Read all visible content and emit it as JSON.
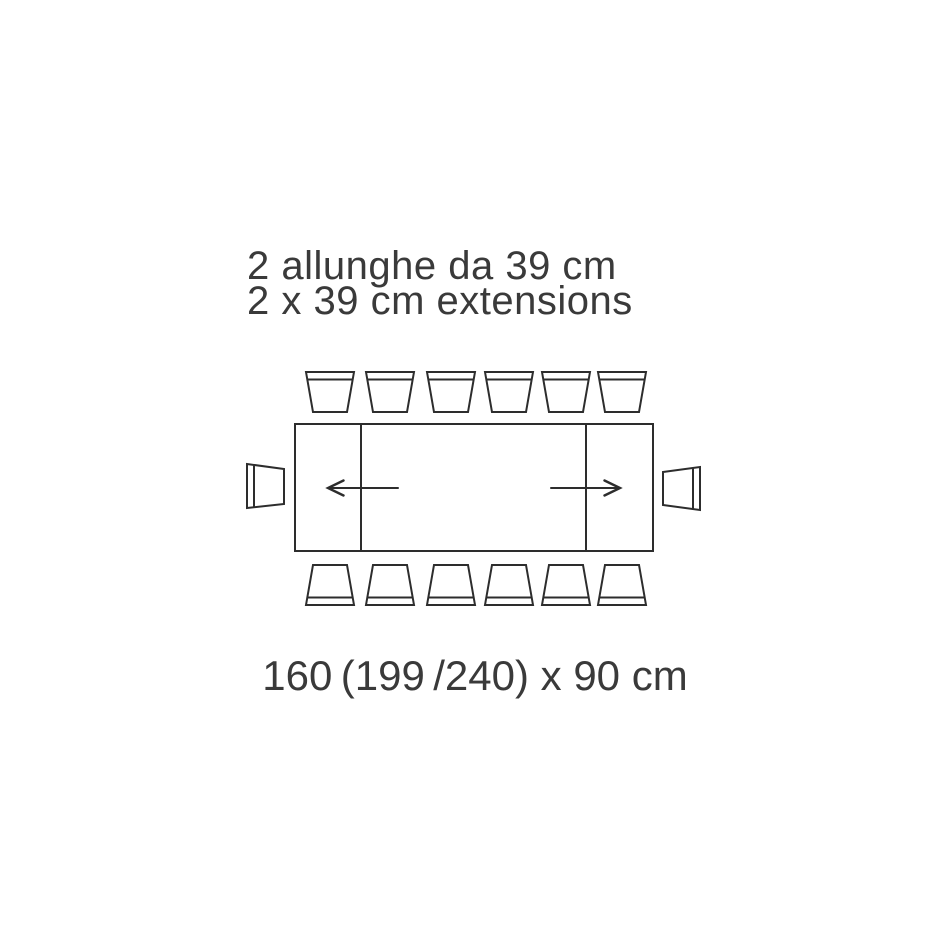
{
  "page": {
    "background": "#ffffff"
  },
  "colors": {
    "line": "#2d2d2d",
    "text": "#3a3a3a"
  },
  "title": {
    "line1_italian": "2 allunghe da 39 cm",
    "line2_english": "2 x 39 cm extensions"
  },
  "dimension_label": "160 (199 /240) x 90 cm",
  "diagram": {
    "type": "extendable-dining-table-top-view",
    "table": {
      "length_closed_cm": 160,
      "length_one_extension_cm": 199,
      "length_full_cm": 240,
      "width_cm": 90
    },
    "extensions": {
      "count": 2,
      "size_cm": 39,
      "directions": [
        "left",
        "right"
      ]
    },
    "chairs": {
      "top_row": 6,
      "bottom_row": 6,
      "left_end": 1,
      "right_end": 1,
      "total": 14
    }
  }
}
